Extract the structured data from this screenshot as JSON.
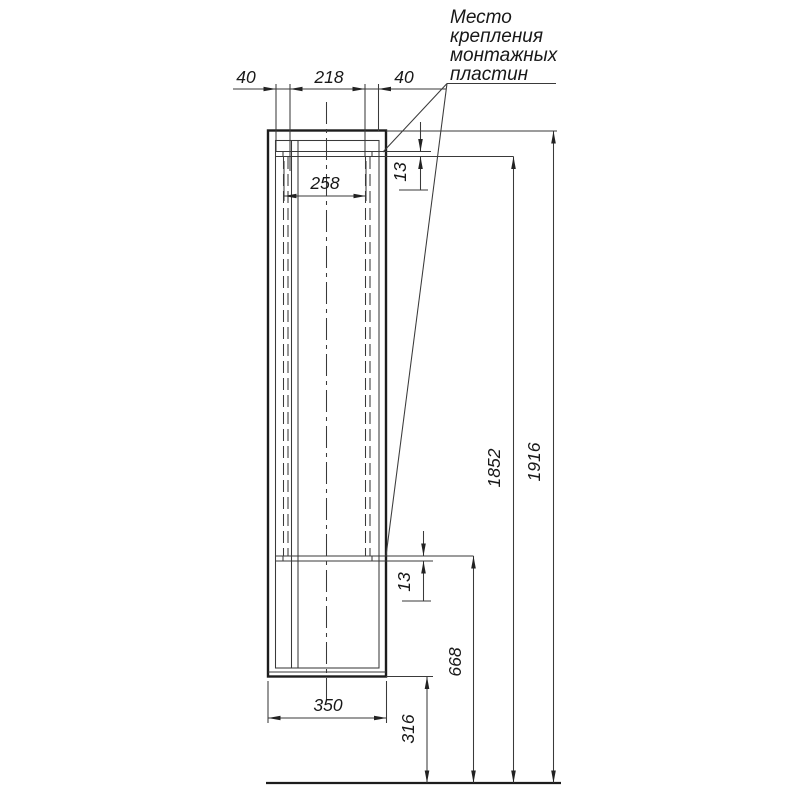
{
  "annotation": {
    "line1": "Место",
    "line2": "крепления",
    "line3": "монтажных",
    "line4": "пластин"
  },
  "dims": {
    "top_left_offset": "40",
    "top_plate_spacing": "218",
    "top_right_offset": "40",
    "inner_span": "258",
    "plate_height_top": "13",
    "plate_height_bottom": "13",
    "lower_plate_height": "668",
    "upper_plate_height": "1852",
    "total_height": "1916",
    "floor_clearance": "316",
    "cabinet_width": "350"
  },
  "colors": {
    "ink": "#1c1c1c",
    "background": "#ffffff"
  }
}
